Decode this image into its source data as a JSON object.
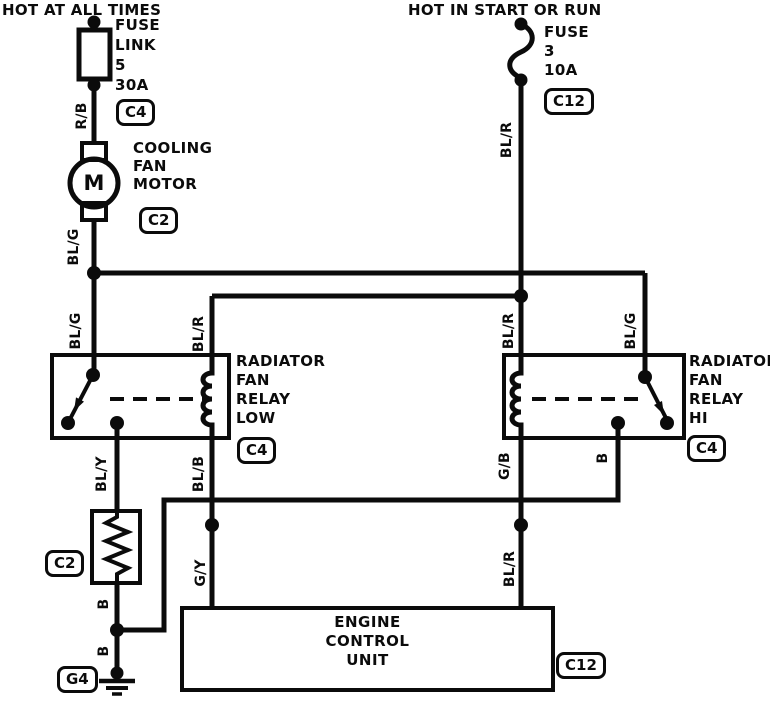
{
  "headers": {
    "left": "HOT AT ALL TIMES",
    "right": "HOT IN START OR RUN"
  },
  "components": {
    "fuse_link": {
      "label": "FUSE\nLINK\n5\n30A",
      "connector": "C4"
    },
    "fuse": {
      "label": "FUSE\n3\n10A",
      "connector": "C12"
    },
    "cooling_fan_motor": {
      "label": "COOLING\nFAN\nMOTOR",
      "symbol": "M",
      "connector": "C2"
    },
    "relay_low": {
      "label": "RADIATOR\nFAN\nRELAY\nLOW",
      "connector": "C4"
    },
    "relay_hi": {
      "label": "RADIATOR\nFAN\nRELAY\nHI",
      "connector": "C4"
    },
    "resistor": {
      "connector": "C2"
    },
    "ground": {
      "connector": "G4"
    },
    "ecu": {
      "label": "ENGINE\nCONTROL\nUNIT",
      "connector": "C12"
    }
  },
  "wires": {
    "r_b": "R/B",
    "bl_r_fuse": "BL/R",
    "bl_g_motor": "BL/G",
    "bl_g_relay_low": "BL/G",
    "bl_r_relay_low": "BL/R",
    "bl_r_relay_hi": "BL/R",
    "bl_g_relay_hi": "BL/G",
    "bl_y": "BL/Y",
    "bl_b": "BL/B",
    "g_b": "G/B",
    "b_relay_hi": "B",
    "g_y": "G/Y",
    "bl_r_ecu": "BL/R",
    "b_resistor": "B",
    "b_ground": "B"
  },
  "colors": {
    "ink": "#0b0b0b",
    "paper": "#ffffff"
  }
}
